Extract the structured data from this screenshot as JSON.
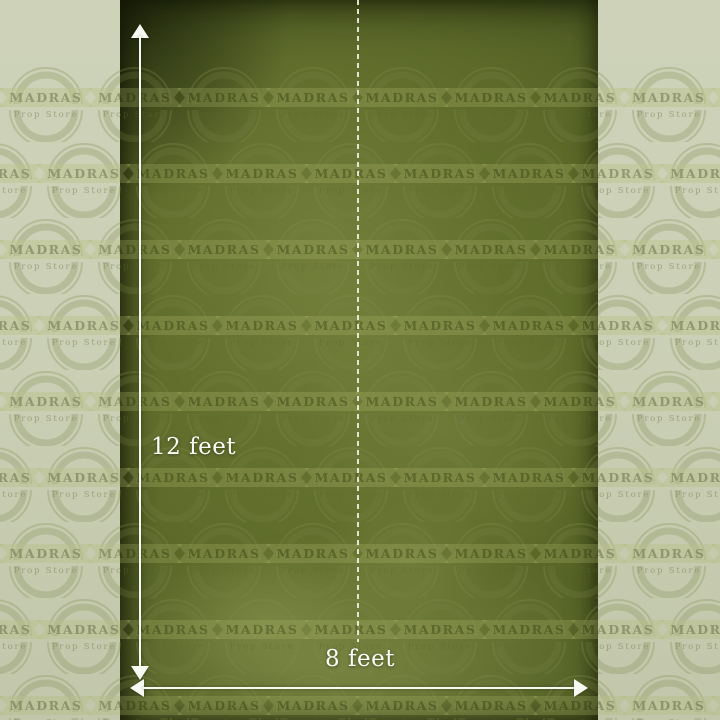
{
  "watermark": {
    "brand": "MADRAS",
    "subtitle": "Prop Store"
  },
  "measurements": {
    "height_label": "12 feet",
    "width_label": "8 feet"
  },
  "colors": {
    "backdrop_green": "#5f6c2b",
    "backdrop_shadow_green": "#3b4618",
    "margin_sage": "#c9ceb4",
    "marker_white": "#f8f9f3",
    "watermark_olive": "#8f9a52"
  }
}
